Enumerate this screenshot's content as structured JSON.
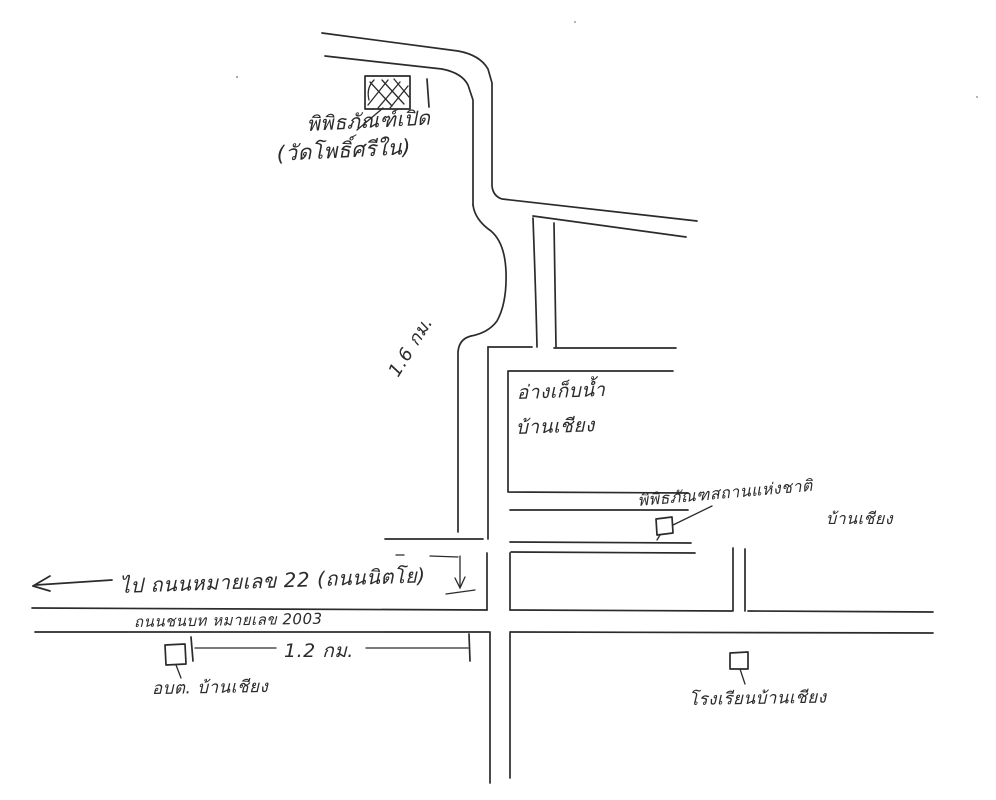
{
  "labels": {
    "open_air_museum_line1": "พิพิธภัณฑ์เปิด",
    "open_air_museum_line2": "(วัดโพธิ์ศรีใน)",
    "vertical_distance": "1.6 กม.",
    "reservoir_line1": "อ่างเก็บน้ำ",
    "reservoir_line2": "บ้านเชียง",
    "national_museum_line1": "พิพิธภัณฑสถานแห่งชาติ",
    "national_museum_line2": "บ้านเชียง",
    "to_highway": "ไป ถนนหมายเลข 22 (ถนนนิตโย)",
    "road_name": "ถนนชนบท หมายเลข 2003",
    "horizontal_distance": "1.2 กม.",
    "sao_office": "อบต. บ้านเชียง",
    "school": "โรงเรียนบ้านเชียง"
  },
  "colors": {
    "ink": "#2b2b2b",
    "paper": "#ffffff"
  }
}
